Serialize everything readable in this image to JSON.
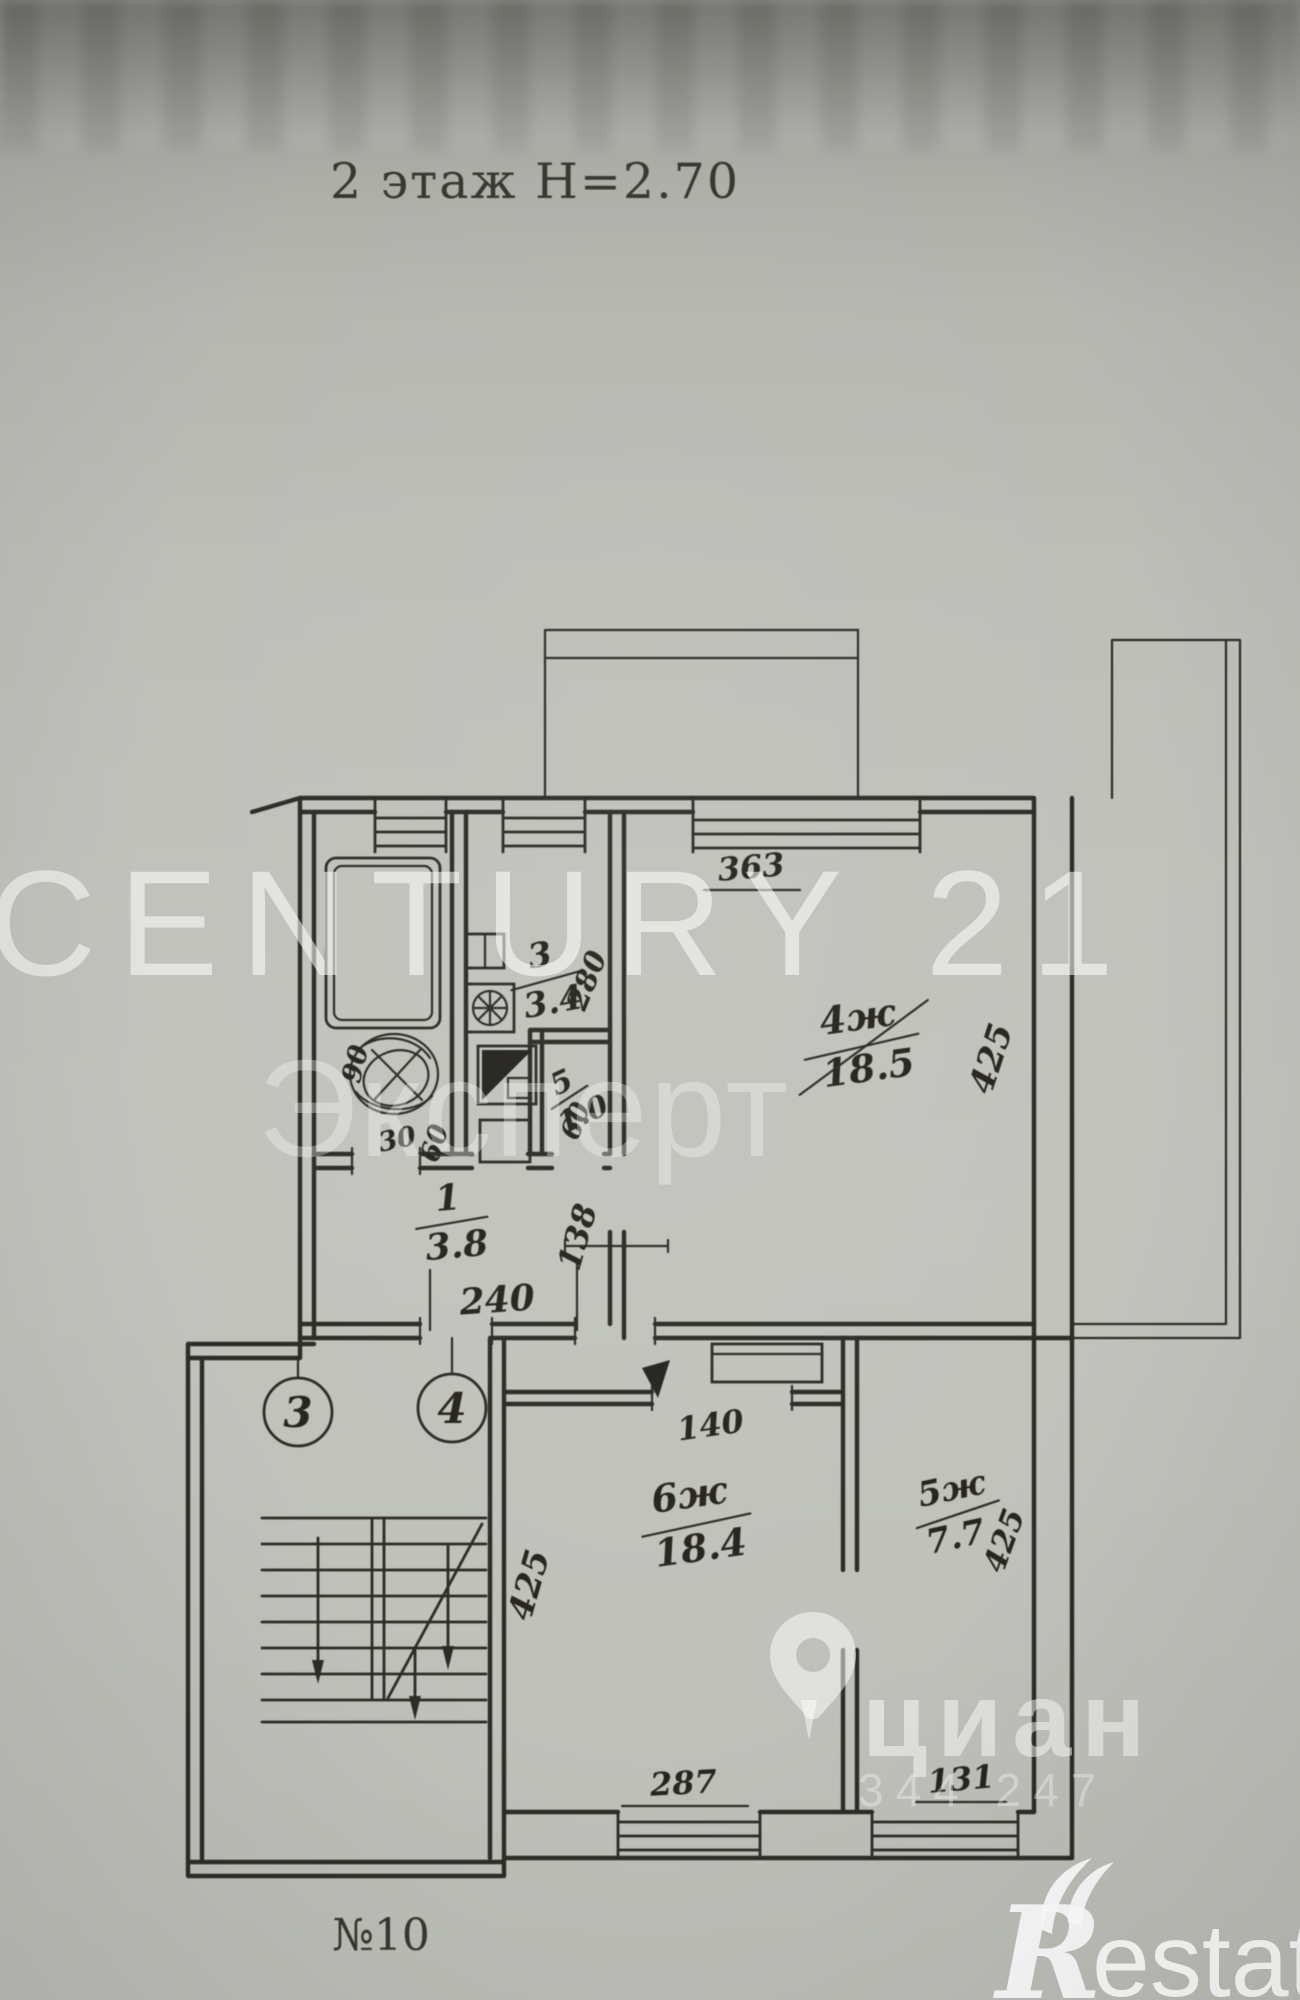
{
  "photo": {
    "title": "2 этаж Н=2.70",
    "apartment_label": "№10"
  },
  "rooms": {
    "hall": {
      "number": "1",
      "area": "3.8"
    },
    "kitchen": {
      "number": "3",
      "area": "3.4"
    },
    "toilet": {
      "number": "5",
      "area": "1.0"
    },
    "living": {
      "number": "4ж",
      "area": "18.5"
    },
    "room6": {
      "number": "6ж",
      "area": "18.4"
    },
    "room5": {
      "number": "5ж",
      "area": "7.7"
    }
  },
  "dims": {
    "win_living": "363",
    "side_living": "425",
    "kitchen_h": "280",
    "hall_w": "240",
    "hall_seg": "138",
    "door_living": "60",
    "bath_w": "90",
    "door_bath": "30",
    "door_small": "60",
    "door_room6": "140",
    "side_room6": "425",
    "side_room5": "425",
    "win_room6": "287",
    "win_room5": "131"
  },
  "stairs": {
    "axis_a": "3",
    "axis_b": "4"
  },
  "watermarks": {
    "century_line1": "CENTURY 21",
    "century_line2": "Эксперт",
    "cian_text": "циан",
    "cian_digits": "344 247",
    "restate_initial": "R",
    "restate_rest": "estate"
  },
  "colors": {
    "ink": "#2b2923",
    "paper": "#c0c1bb",
    "watermark": "#ffffff"
  }
}
